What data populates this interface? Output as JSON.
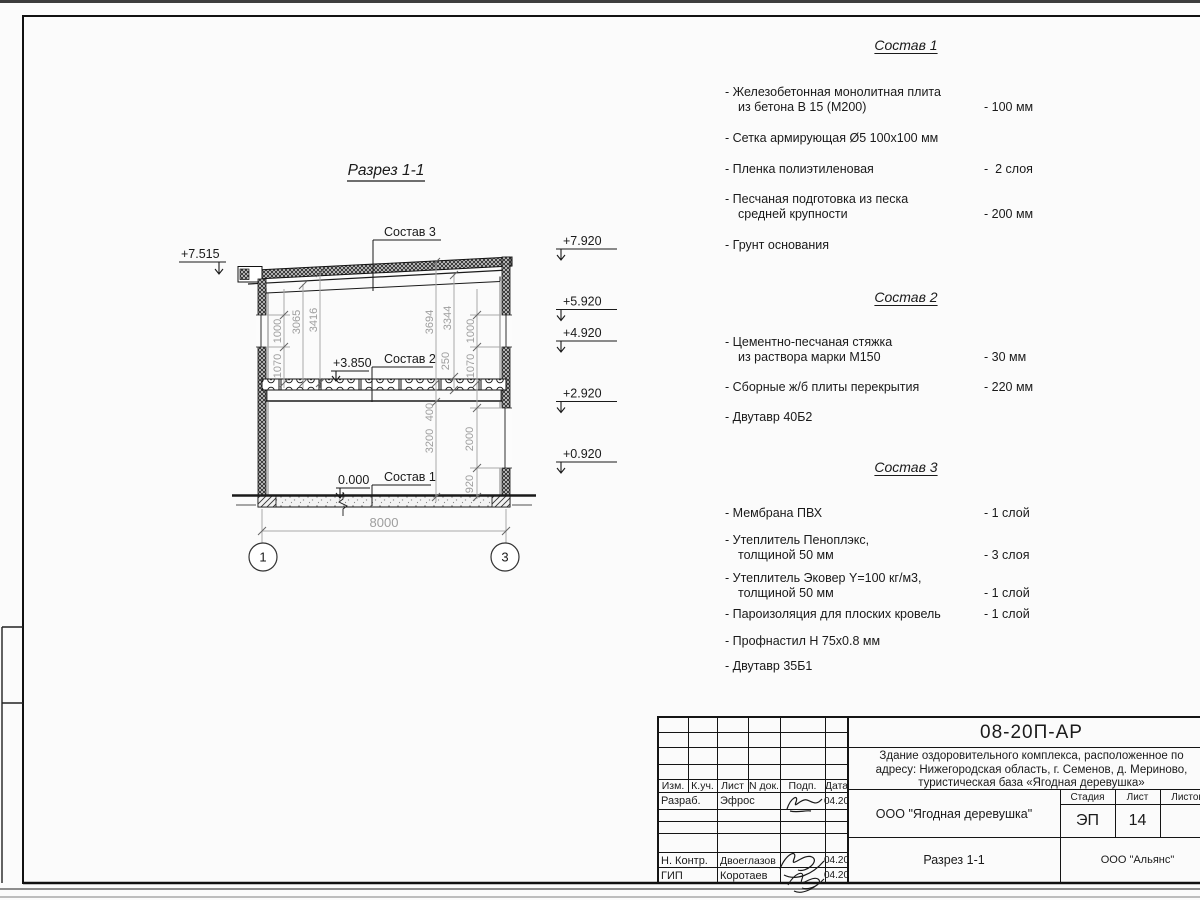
{
  "colors": {
    "line": "#1a1a1a",
    "dim_gray": "#9e9e9e",
    "paper": "#fbfbfb"
  },
  "section": {
    "title": "Разрез 1-1",
    "labels": {
      "sostav3": "Состав 3",
      "sostav2": "Состав 2",
      "sostav1": "Состав 1"
    },
    "elevations": {
      "left_eaves": "+7.515",
      "right_1": "+7.920",
      "right_2": "+5.920",
      "right_3": "+4.920",
      "right_4": "+2.920",
      "right_5": "+0.920",
      "floor2": "+3.850",
      "floor0": "0.000"
    },
    "dims": {
      "l_win": "1000",
      "l_sill": "1070",
      "l_3065": "3065",
      "l_3416": "3416",
      "r_3694": "3694",
      "r_3344": "3344",
      "r_250": "250",
      "r_win": "1000",
      "r_sill": "1070",
      "r_400": "400",
      "r_3200": "3200",
      "r_2000": "2000",
      "r_920": "920",
      "span": "8000"
    },
    "axes": {
      "a1": "1",
      "a2": "3"
    }
  },
  "specs": [
    {
      "title": "Состав 1",
      "items": [
        {
          "text": "- Железобетонная  монолитная плита",
          "text2": "из бетона В 15 (М200)",
          "value": "- 100 мм"
        },
        {
          "text": "- Сетка армирующая Ø5 100х100 мм",
          "text2": "",
          "value": ""
        },
        {
          "text": "- Пленка полиэтиленовая",
          "text2": "",
          "value": "-  2 слоя"
        },
        {
          "text": "- Песчаная подготовка из песка",
          "text2": "средней крупности",
          "value": "- 200 мм"
        },
        {
          "text": "- Грунт основания",
          "text2": "",
          "value": ""
        }
      ]
    },
    {
      "title": "Состав 2",
      "items": [
        {
          "text": "- Цементно-песчаная стяжка",
          "text2": "из раствора марки М150",
          "value": "- 30 мм"
        },
        {
          "text": "- Сборные ж/б плиты перекрытия",
          "text2": "",
          "value": "- 220 мм"
        },
        {
          "text": "- Двутавр 40Б2",
          "text2": "",
          "value": ""
        }
      ]
    },
    {
      "title": "Состав 3",
      "items": [
        {
          "text": "- Мембрана ПВХ",
          "text2": "",
          "value": "- 1 слой"
        },
        {
          "text": "- Утеплитель Пеноплэкс,",
          "text2": "толщиной 50 мм",
          "value": "- 3 слоя"
        },
        {
          "text": "- Утеплитель Эковер Y=100 кг/м3,",
          "text2": "толщиной 50 мм",
          "value": "- 1 слой"
        },
        {
          "text": "- Пароизоляция для плоских кровель",
          "text2": "",
          "value": "- 1 слой"
        },
        {
          "text": "- Профнастил Н 75х0.8 мм",
          "text2": "",
          "value": ""
        },
        {
          "text": "- Двутавр 35Б1",
          "text2": "",
          "value": ""
        }
      ]
    }
  ],
  "titleblock": {
    "doc_number": "08-20П-АР",
    "description_line1": "Здание оздоровительного комплекса, расположенное по",
    "description_line2": "адресу: Нижегородская область, г. Семенов, д. Мериново,",
    "description_line3": "туристическая база «Ягодная деревушка»",
    "client": "ООО \"Ягодная деревушка\"",
    "sheet_title": "Разрез 1-1",
    "company": "ООО \"Альянс\"",
    "stage_label": "Стадия",
    "sheet_label": "Лист",
    "sheets_label": "Листов",
    "stage_value": "ЭП",
    "sheet_value": "14",
    "cols": {
      "izm": "Изм.",
      "kuch": "К.уч.",
      "list": "Лист",
      "ndoc": "N док.",
      "podp": "Подп.",
      "data": "Дата"
    },
    "rows": [
      {
        "role": "Разраб.",
        "name": "Эфрос",
        "date": "04.20"
      },
      {
        "role": "",
        "name": "",
        "date": ""
      },
      {
        "role": "",
        "name": "",
        "date": ""
      },
      {
        "role": "",
        "name": "",
        "date": ""
      },
      {
        "role": "Н. Контр.",
        "name": "Двоеглазов",
        "date": "04.20"
      },
      {
        "role": "ГИП",
        "name": "Коротаев",
        "date": "04.20"
      }
    ]
  }
}
